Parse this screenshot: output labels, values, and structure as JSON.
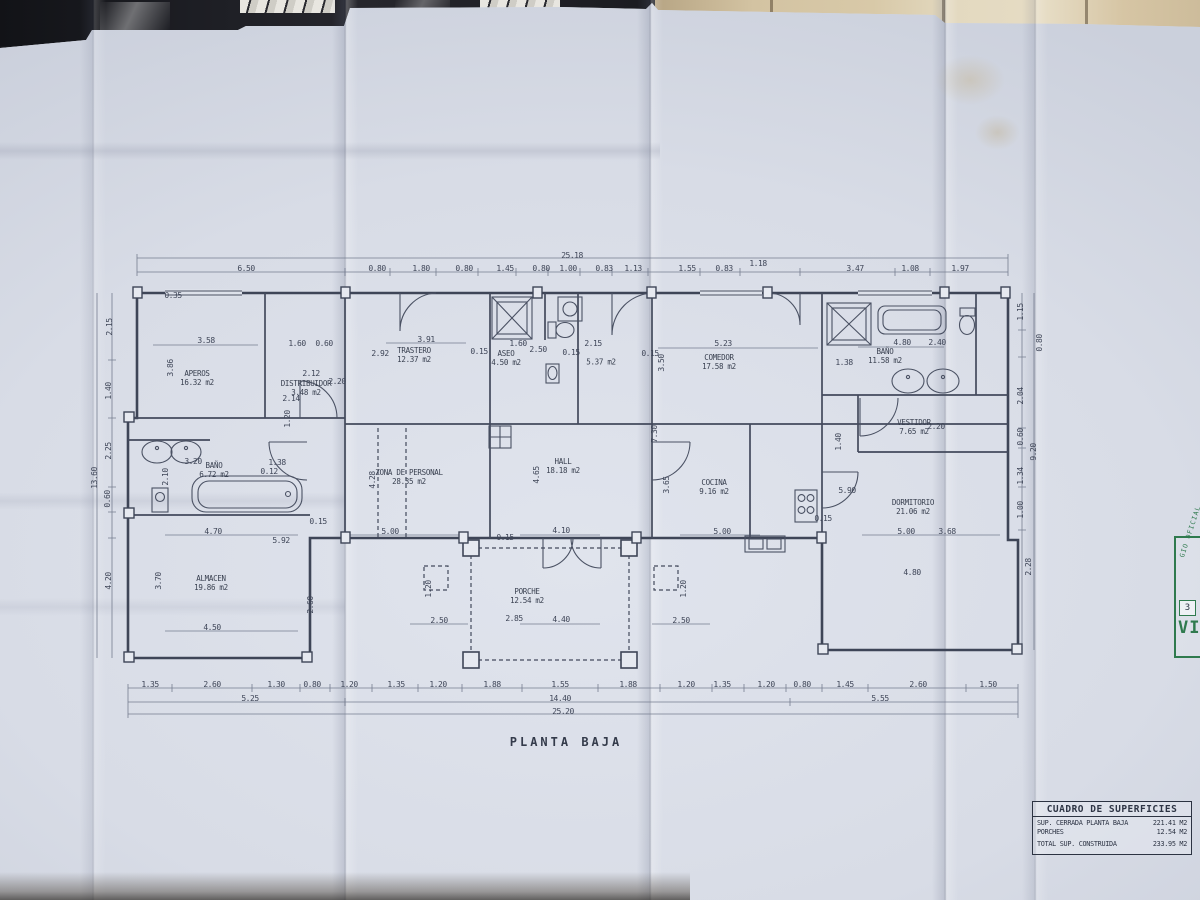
{
  "title": "PLANTA BAJA",
  "table": {
    "title": "CUADRO DE SUPERFICIES",
    "rows": [
      {
        "label": "SUP. CERRADA PLANTA BAJA",
        "value": "221.41 M2"
      },
      {
        "label": "PORCHES",
        "value": "12.54 M2"
      },
      {
        "label": "TOTAL SUP. CONSTRUIDA",
        "value": "233.95 M2"
      }
    ]
  },
  "stamp": {
    "arc_text": "GIO OFICIAL",
    "box_text": "3",
    "big_text": "VI"
  },
  "plan": {
    "rooms": [
      {
        "n": "APEROS",
        "a": "16.32 m2",
        "x": 197,
        "y": 378
      },
      {
        "n": "DISTRIBUIDOR",
        "a": "3.48 m2",
        "x": 306,
        "y": 388
      },
      {
        "n": "TRASTERO",
        "a": "12.37 m2",
        "x": 414,
        "y": 355
      },
      {
        "n": "ASEO",
        "a": "4.50 m2",
        "x": 506,
        "y": 358
      },
      {
        "n": "",
        "a": "5.37 m2",
        "x": 601,
        "y": 362
      },
      {
        "n": "COMEDOR",
        "a": "17.58 m2",
        "x": 719,
        "y": 362
      },
      {
        "n": "BAÑO",
        "a": "11.58 m2",
        "x": 885,
        "y": 356
      },
      {
        "n": "VESTIDOR",
        "a": "7.65 m2",
        "x": 914,
        "y": 427
      },
      {
        "n": "ZONA DE PERSONAL",
        "a": "28.35 m2",
        "x": 409,
        "y": 477
      },
      {
        "n": "HALL",
        "a": "18.18 m2",
        "x": 563,
        "y": 466
      },
      {
        "n": "COCINA",
        "a": "9.16 m2",
        "x": 714,
        "y": 487
      },
      {
        "n": "DORMITORIO",
        "a": "21.06 m2",
        "x": 913,
        "y": 507
      },
      {
        "n": "BAÑO",
        "a": "6.72 m2",
        "x": 214,
        "y": 470
      },
      {
        "n": "ALMACEN",
        "a": "19.86 m2",
        "x": 211,
        "y": 583
      },
      {
        "n": "PORCHE",
        "a": "12.54 m2",
        "x": 527,
        "y": 596
      }
    ],
    "dimensions": [
      [
        "25.18",
        572,
        256
      ],
      [
        "6.50",
        246,
        269
      ],
      [
        "0.80",
        377,
        269
      ],
      [
        "1.80",
        421,
        269
      ],
      [
        "0.80",
        464,
        269
      ],
      [
        "1.45",
        505,
        269
      ],
      [
        "0.80",
        541,
        269
      ],
      [
        "1.00",
        568,
        269
      ],
      [
        "0.83",
        604,
        269
      ],
      [
        "1.13",
        633,
        269
      ],
      [
        "1.55",
        687,
        269
      ],
      [
        "0.83",
        724,
        269
      ],
      [
        "1.18",
        758,
        264
      ],
      [
        "3.47",
        855,
        269
      ],
      [
        "1.08",
        910,
        269
      ],
      [
        "1.97",
        960,
        269
      ],
      [
        "0.35",
        173,
        296
      ],
      [
        "2.15",
        110,
        327,
        "v"
      ],
      [
        "1.40",
        109,
        391,
        "v"
      ],
      [
        "2.25",
        109,
        451,
        "v"
      ],
      [
        "13.60",
        95,
        478,
        "v"
      ],
      [
        "0.60",
        108,
        499,
        "v"
      ],
      [
        "4.20",
        109,
        581,
        "v"
      ],
      [
        "1.15",
        1021,
        312,
        "v"
      ],
      [
        "0.80",
        1040,
        343,
        "v"
      ],
      [
        "2.04",
        1021,
        396,
        "v"
      ],
      [
        "0.60",
        1021,
        437,
        "v"
      ],
      [
        "9.20",
        1034,
        452,
        "v"
      ],
      [
        "1.34",
        1021,
        476,
        "v"
      ],
      [
        "1.00",
        1021,
        510,
        "v"
      ],
      [
        "2.28",
        1029,
        567,
        "v"
      ],
      [
        "3.58",
        206,
        341
      ],
      [
        "1.60",
        297,
        344
      ],
      [
        "0.60",
        324,
        344
      ],
      [
        "3.86",
        171,
        368,
        "v"
      ],
      [
        "2.92",
        380,
        354
      ],
      [
        "3.91",
        426,
        340
      ],
      [
        "0.15",
        479,
        352
      ],
      [
        "1.60",
        518,
        344
      ],
      [
        "2.50",
        538,
        350
      ],
      [
        "0.15",
        571,
        353
      ],
      [
        "2.15",
        593,
        344
      ],
      [
        "0.15",
        650,
        354
      ],
      [
        "3.50",
        662,
        363,
        "v"
      ],
      [
        "5.23",
        723,
        344
      ],
      [
        "1.38",
        844,
        363
      ],
      [
        "4.80",
        902,
        343
      ],
      [
        "2.40",
        937,
        343
      ],
      [
        "2.12",
        311,
        374
      ],
      [
        "2.20",
        337,
        382
      ],
      [
        "2.14",
        291,
        399
      ],
      [
        "1.20",
        288,
        419,
        "v"
      ],
      [
        "7.30",
        655,
        434,
        "v"
      ],
      [
        "1.40",
        839,
        442,
        "v"
      ],
      [
        "2.20",
        936,
        427
      ],
      [
        "1.38",
        277,
        463
      ],
      [
        "0.12",
        269,
        472
      ],
      [
        "3.20",
        193,
        462
      ],
      [
        "2.10",
        166,
        477,
        "v"
      ],
      [
        "4.70",
        213,
        532
      ],
      [
        "5.92",
        281,
        541
      ],
      [
        "4.28",
        373,
        480,
        "v"
      ],
      [
        "4.65",
        537,
        475,
        "v"
      ],
      [
        "3.65",
        667,
        485,
        "v"
      ],
      [
        "5.90",
        847,
        491
      ],
      [
        "0.15",
        318,
        522
      ],
      [
        "5.00",
        390,
        532
      ],
      [
        "0.15",
        505,
        538
      ],
      [
        "4.10",
        561,
        531
      ],
      [
        "5.00",
        722,
        532
      ],
      [
        "0.15",
        823,
        519
      ],
      [
        "5.00",
        906,
        532
      ],
      [
        "3.68",
        947,
        532
      ],
      [
        "4.80",
        912,
        573
      ],
      [
        "3.70",
        159,
        581,
        "v"
      ],
      [
        "4.50",
        212,
        628
      ],
      [
        "2.60",
        311,
        605,
        "v"
      ],
      [
        "1.20",
        429,
        589,
        "v"
      ],
      [
        "1.20",
        684,
        589,
        "v"
      ],
      [
        "2.50",
        439,
        621
      ],
      [
        "2.85",
        514,
        619
      ],
      [
        "4.40",
        561,
        620
      ],
      [
        "2.50",
        681,
        621
      ],
      [
        "1.35",
        150,
        685
      ],
      [
        "2.60",
        212,
        685
      ],
      [
        "1.30",
        276,
        685
      ],
      [
        "0.80",
        312,
        685
      ],
      [
        "1.20",
        349,
        685
      ],
      [
        "1.35",
        396,
        685
      ],
      [
        "1.20",
        438,
        685
      ],
      [
        "1.88",
        492,
        685
      ],
      [
        "1.55",
        560,
        685
      ],
      [
        "1.88",
        628,
        685
      ],
      [
        "1.20",
        686,
        685
      ],
      [
        "1.35",
        722,
        685
      ],
      [
        "1.20",
        766,
        685
      ],
      [
        "0.80",
        802,
        685
      ],
      [
        "1.45",
        845,
        685
      ],
      [
        "2.60",
        918,
        685
      ],
      [
        "1.50",
        988,
        685
      ],
      [
        "5.25",
        250,
        699
      ],
      [
        "14.40",
        560,
        699
      ],
      [
        "5.55",
        880,
        699
      ],
      [
        "25.20",
        563,
        712
      ]
    ]
  }
}
